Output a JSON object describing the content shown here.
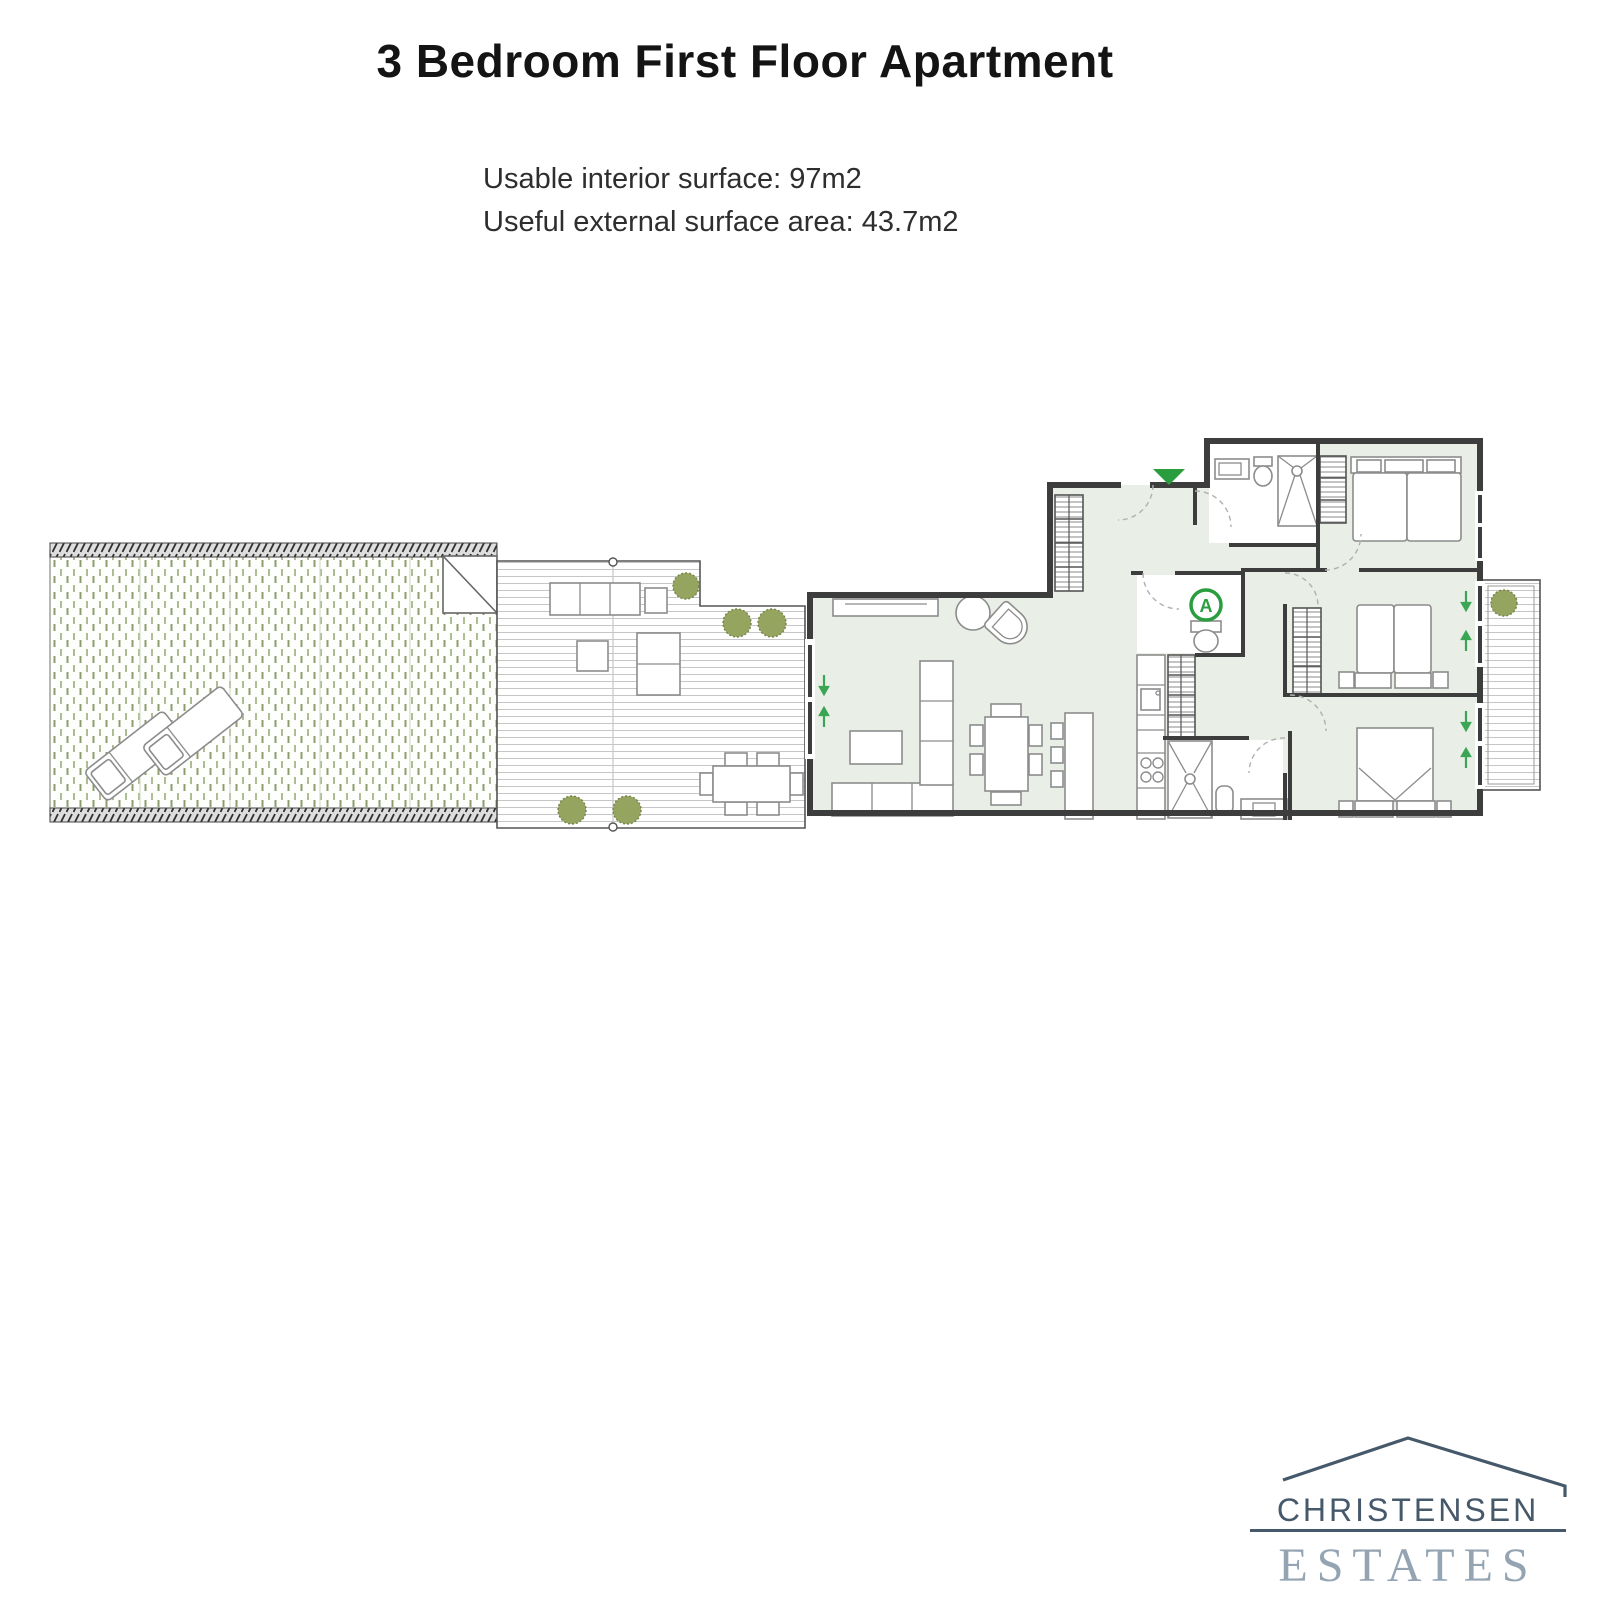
{
  "page": {
    "title": "3 Bedroom First Floor Apartment",
    "surface_line1": "Usable interior surface: 97m2",
    "surface_line2": "Useful external surface area: 43.7m2"
  },
  "floorplan": {
    "entrance_marker": "A"
  },
  "logo": {
    "name": "CHRISTENSEN",
    "division": "ESTATES"
  },
  "colors": {
    "accent_green": "#2a9d3f",
    "arrow_green": "#3aa655",
    "floor_tint": "#e9efe6",
    "wall": "#3d3d3d",
    "logo_primary": "#46596b",
    "logo_secondary": "#94a4b3"
  }
}
